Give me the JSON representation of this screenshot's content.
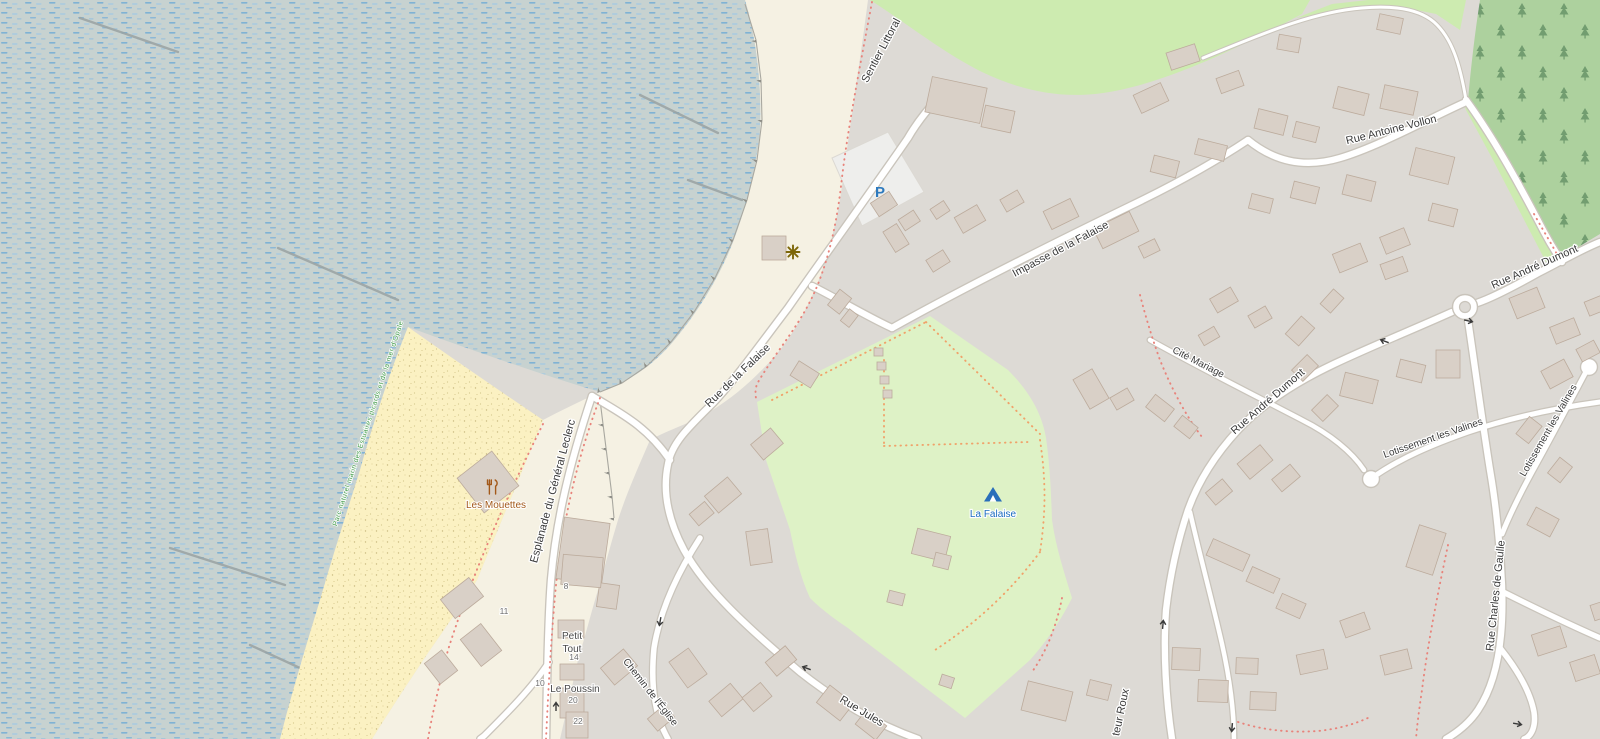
{
  "map": {
    "streets": {
      "sentier_littoral": "Sentier Littoral",
      "impasse_de_la_falaise": "Impasse de la Falaise",
      "rue_de_la_falaise": "Rue de la Falaise",
      "esplanade": "Esplanade du Général Leclerc",
      "antoine_vollon": "Rue Antoine Vollon",
      "andre_dumont": "Rue André Dumont",
      "charles_de_gaulle": "Rue Charles de Gaulle",
      "lotissement_les_valines": "Lotissement les Valines",
      "cite_mariage": "Cité Mariage",
      "chemin_eglise": "Chemin de l'Église",
      "rue_jules": "Rue Jules",
      "docteur_roux_partial": "teur Roux"
    },
    "places": {
      "nature_park": "Parc naturel marin des Estuaires picards et de la mer d'Opale",
      "camping": "La Falaise",
      "restaurant": "Les Mouettes",
      "petit_tout_line1": "Petit",
      "petit_tout_line2": "Tout",
      "le_poussin": "Le Poussin"
    },
    "house_numbers": {
      "n8": "8",
      "n11": "11",
      "n10": "10",
      "n14": "14",
      "n20": "20",
      "n22": "22"
    },
    "icons": {
      "parking_letter": "P"
    },
    "colors": {
      "residential": "#dddad5",
      "promenade": "#f5f1e3",
      "water_base": "#c7d2d0",
      "water_dash": "#7fb2d4",
      "beach": "#fbf1c2",
      "grass": "#cdebb0",
      "campsite": "#def2c6",
      "forest": "#add19e",
      "building": "#d9d0c7",
      "road_casing": "#c9c4bb",
      "path_red": "#e8837b",
      "path_orange": "#f0a26a",
      "parking_blue": "#2e7abe",
      "tourism_blue": "#1a6bbf",
      "amenity_orange": "#a3591a",
      "nature_green": "#3f9a47"
    }
  }
}
